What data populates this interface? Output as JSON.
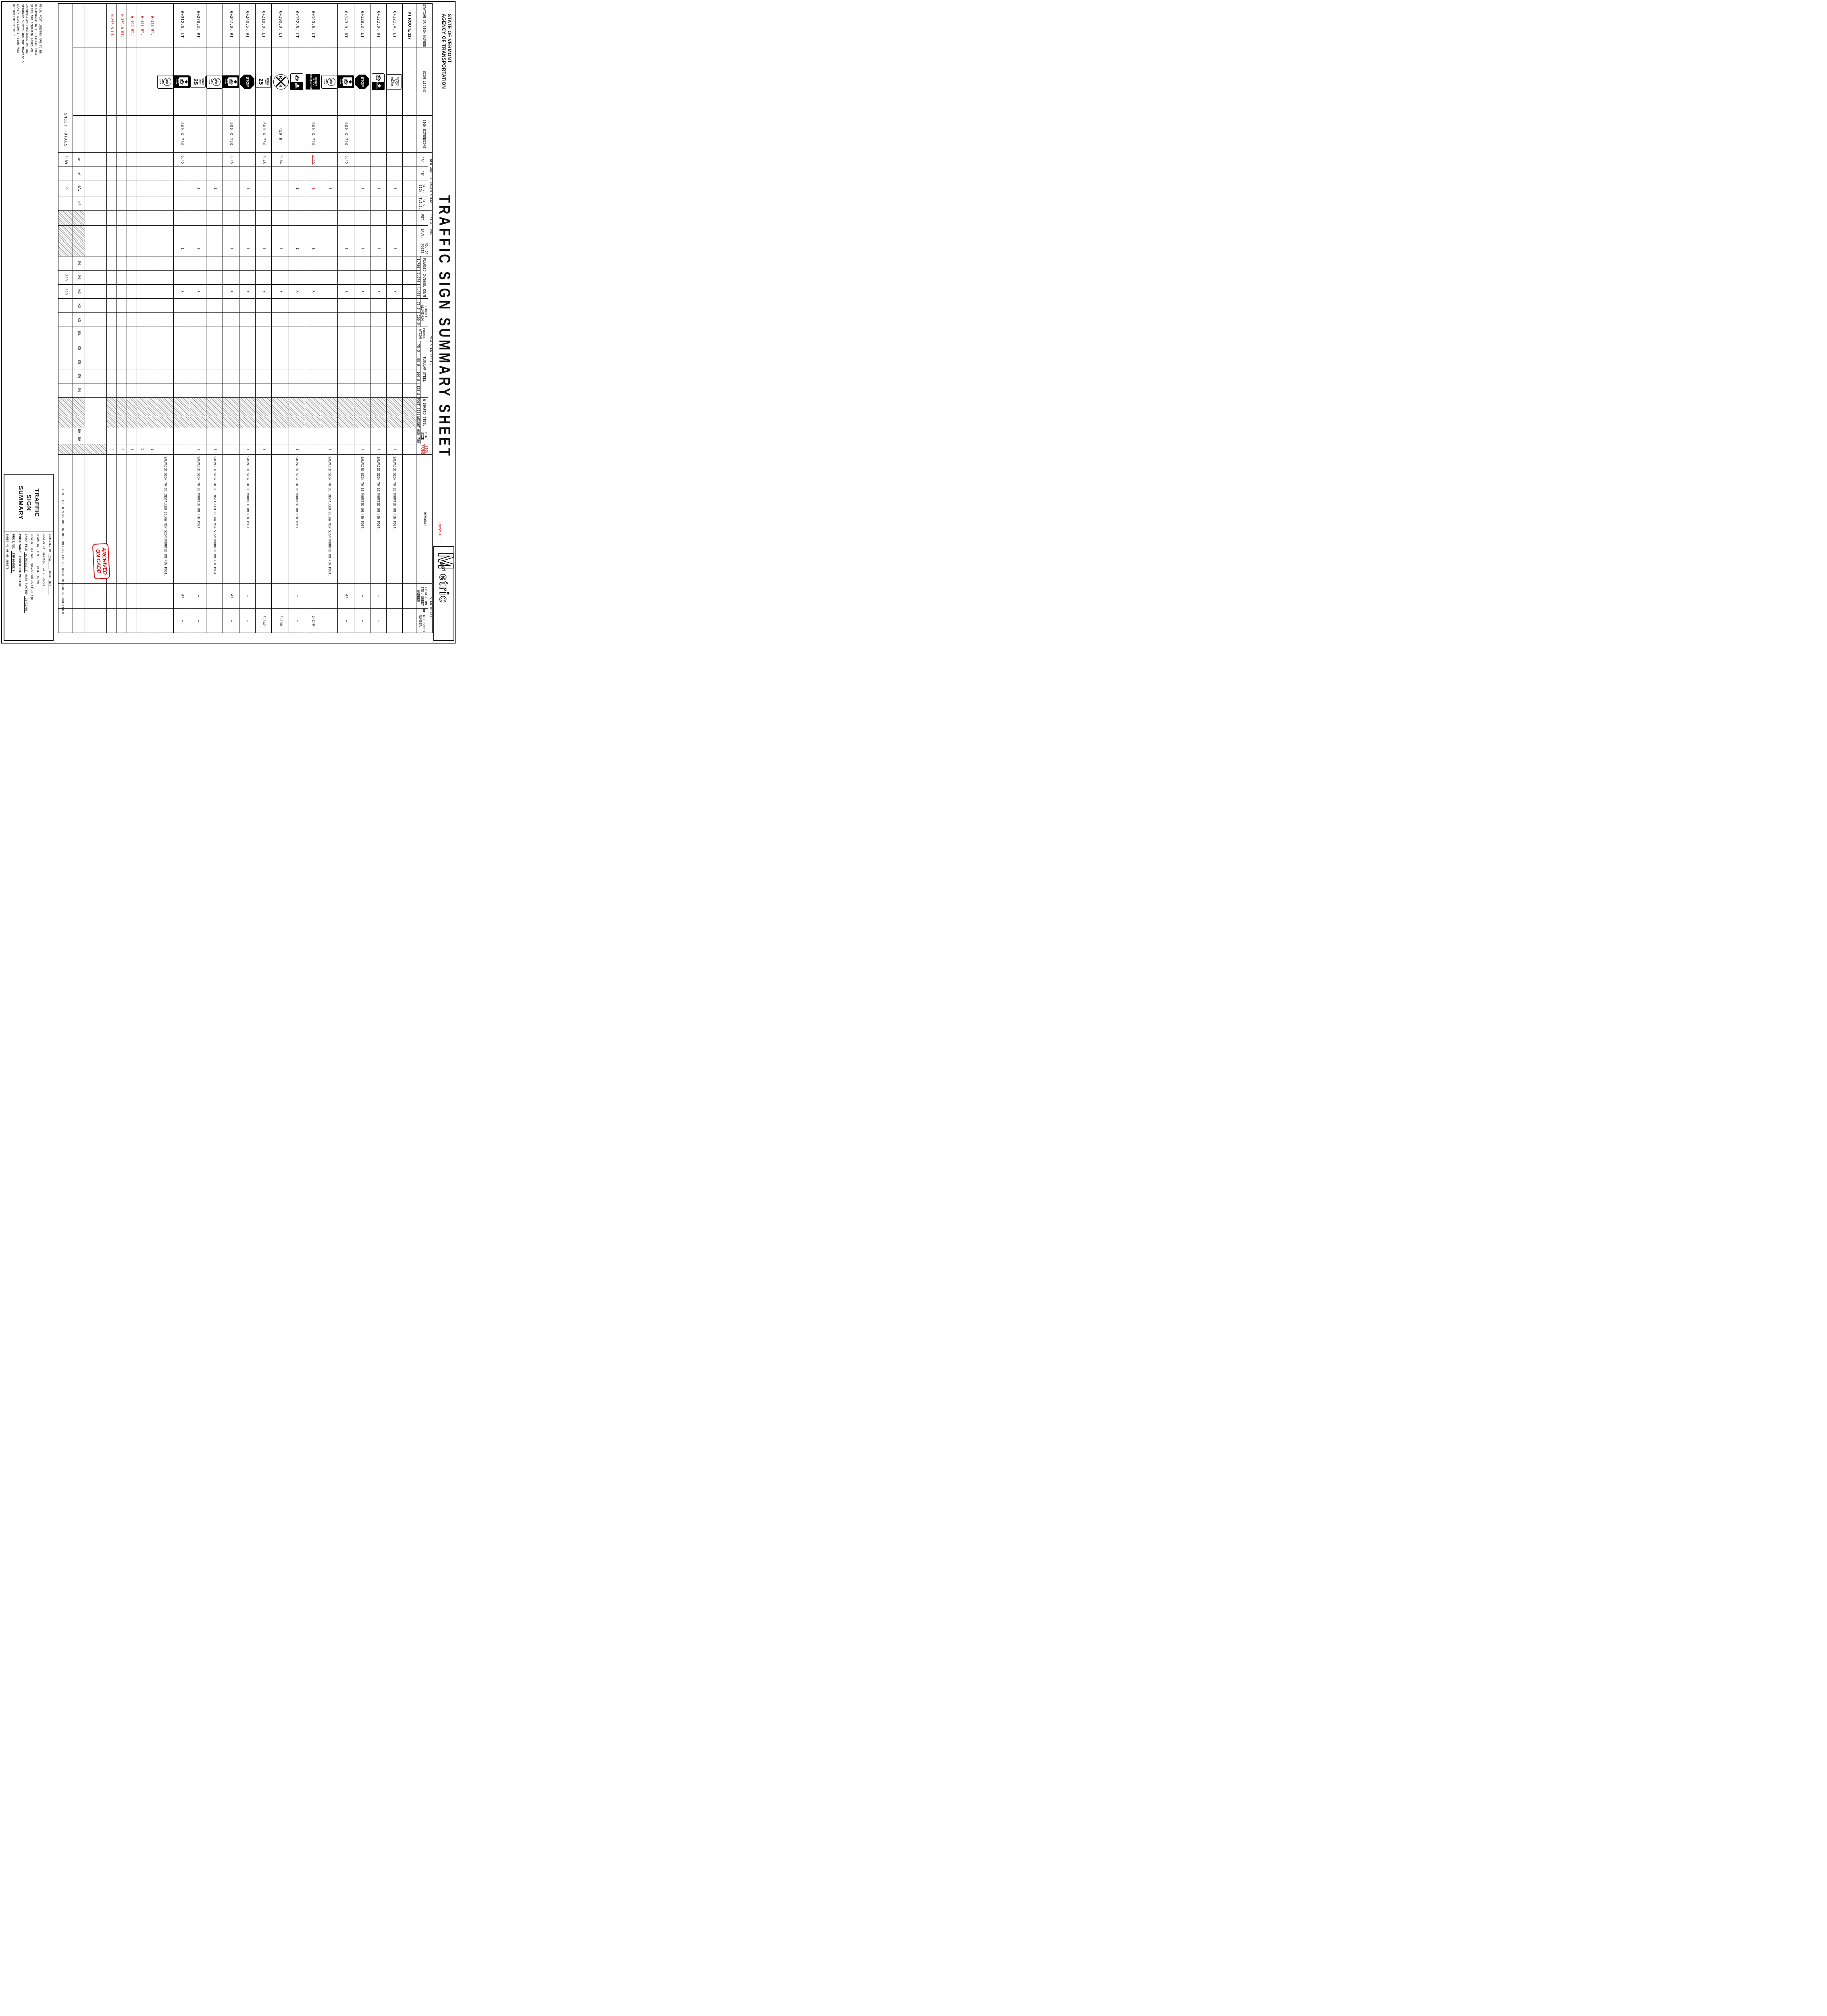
{
  "sheet": {
    "agency_line1": "STATE OF VERMONT",
    "agency_line2": "AGENCY OF TRANSPORTATION",
    "title": "TRAFFIC SIGN SUMMARY SHEET",
    "logo": {
      "m": "M",
      "vaot": "VAOT",
      "rest": "etric"
    }
  },
  "headers": {
    "station": "STATION OR SIGN NUMBER",
    "legend": "SIGN LEGEND",
    "dims": "SIGN DIMENSIONS",
    "new_salvaged": "NEW AND SALVAGED SIGNS",
    "a": "\"A\"",
    "b": "\"B\"",
    "salv_sign": "SALV. SIGN",
    "salv_tis": "SALV. T.I.S.",
    "exist_post": "EXIST. POST",
    "ret": "RET.",
    "salv": "SALV.",
    "posts": "NO. OF POSTS",
    "new_sign_posts": "NEW SIGN POSTS",
    "flanged": "FLANGED CHANNEL KG/M",
    "fc1": "1.786",
    "fc2": "2.976",
    "fc3": "4.465",
    "tub_alum": "TUBULAR ALUMINUM",
    "ta75": "75 Ø",
    "ta100": "100 Ø",
    "foundation": "FOUND- ATION",
    "tub_steel": "TUBULAR STEEL",
    "ts75": "75 Ø",
    "ts90": "90 Ø",
    "ts100": "100 Ø",
    "ts125": "125 Ø",
    "w_shaped": "W SHAPED STEEL",
    "post_size": "POST SIZE",
    "weight": "WEIGHT",
    "ftg": "FTG. SIZE",
    "ftg600": "600",
    "ftg750": "750",
    "frame": "SIGN FRAME",
    "frame_note": "Remove",
    "remarks": "REMARKS",
    "sign_detail": "SIGN DETAIL",
    "detail_std": "DETAIL ON STD. SHEET NUMBER",
    "detail_sheet": "DETAIL SHEET NUMBER"
  },
  "icons": {
    "do-not-stop-on-tracks": {
      "kind": "text-white",
      "lines": [
        "DO NOT",
        "STOP",
        "ON",
        "TRACKS"
      ]
    },
    "do-not-block-intersection": {
      "kind": "text-black",
      "lines": [
        "DO NOT",
        "BLOCK",
        "INTERSECTION"
      ]
    },
    "stop": {
      "kind": "octagon",
      "lines": [
        "STOP"
      ]
    },
    "speed-limit-25": {
      "kind": "speed",
      "lines": [
        "SPEED",
        "LIMIT"
      ],
      "value": "25"
    },
    "rxr": {
      "kind": "rxr",
      "left": "R",
      "right": "R"
    },
    "bike-lane-ahead": {
      "kind": "bike-split",
      "panel": "LANE",
      "word": "AHEAD"
    },
    "bike-lane-ends": {
      "kind": "bike-split",
      "panel": "LANE",
      "word": "ENDS"
    },
    "right-lane-bike-only": {
      "kind": "bike-panel",
      "panel_word": "ONLY",
      "side": [
        "RIGHT",
        "LANE"
      ]
    },
    "bike-lane": {
      "kind": "bike-circle",
      "lines": [
        "BIKE",
        "LANE"
      ]
    }
  },
  "rows": [
    {
      "station": "VT ROUTE 117",
      "bold": true
    },
    {
      "station": "0+121.4, LT.",
      "icon": "do-not-stop-on-tracks",
      "salv_sign": "1",
      "posts": "1",
      "fc3": "X",
      "frame": "1",
      "remarks": "SALVAGED SIGN TO BE MOUNTED ON NEW POST.",
      "detail_std": "—",
      "detail_sheet": "—"
    },
    {
      "station": "0+122.0, RT.",
      "icon": "bike-lane-ahead",
      "salv_sign": "1",
      "posts": "1",
      "fc3": "X",
      "frame": "1",
      "remarks": "SALVAGED SIGN TO BE MOUNTED ON NEW POST.",
      "detail_std": "—",
      "detail_sheet": "—"
    },
    {
      "station": "0+128.3, LT.",
      "icon": "stop",
      "salv_sign": "1",
      "posts": "1",
      "fc3": "X",
      "frame": "1",
      "remarks": "SALVAGED SIGN TO BE MOUNTED ON NEW POST.",
      "detail_std": "—",
      "detail_sheet": "—"
    },
    {
      "station": "0+143.0, RT.",
      "icon": "right-lane-bike-only",
      "dims": "600 X 750",
      "a": "0.45",
      "posts": "1",
      "fc3": "X",
      "detail_std": "47",
      "detail_sheet": "—"
    },
    {
      "station": "",
      "icon": "bike-lane",
      "salv_sign": "1",
      "frame": "1",
      "remarks": "SALVAGED SIGN TO BE INSTALLED BELOW NEW SIGN MOUNTED ON NEW POST.",
      "detail_std": "—",
      "detail_sheet": "—"
    },
    {
      "station": "0+145.6, LT.",
      "icon": "do-not-block-intersection",
      "dims": "600 X 750",
      "a": "0.45",
      "a_struck": true,
      "salv_sign": "1",
      "salv_red": true,
      "posts": "1",
      "fc3": "X",
      "detail_sheet": "E-140"
    },
    {
      "station": "0+152.8, LT.",
      "icon": "bike-lane-ends",
      "salv_sign": "1",
      "posts": "1",
      "fc3": "X",
      "frame": "1",
      "remarks": "SALVAGED SIGN TO BE MOUNTED ON NEW POST.",
      "detail_std": "—",
      "detail_sheet": "—"
    },
    {
      "station": "0+190.0, LT.",
      "icon": "rxr",
      "dims": "450 R",
      "a": "0.64",
      "posts": "1",
      "fc3": "X",
      "detail_sheet": "E-190"
    },
    {
      "station": "0+218.0, LT.",
      "icon": "speed-limit-25",
      "dims": "600 X 750",
      "a": "0.45",
      "posts": "1",
      "fc3": "X",
      "frame": "1",
      "detail_sheet": "E-142"
    },
    {
      "station": "0+240.5, RT.",
      "icon": "stop",
      "salv_sign": "1",
      "posts": "1",
      "fc3": "X",
      "frame": "1",
      "remarks": "SALVAGED SIGN TO BE MOUNTED ON NEW POST.",
      "detail_std": "—",
      "detail_sheet": "—"
    },
    {
      "station": "0+247.0, RT.",
      "icon": "right-lane-bike-only",
      "dims": "600 X 750",
      "a": "0.45",
      "posts": "1",
      "fc3": "X",
      "detail_std": "47",
      "detail_sheet": "—"
    },
    {
      "station": "",
      "icon": "bike-lane",
      "salv_sign": "1",
      "frame": "1",
      "remarks": "SALVAGED SIGN TO BE INSTALLED BELOW NEW SIGN MOUNTED ON NEW POST.",
      "detail_std": "—",
      "detail_sheet": "—"
    },
    {
      "station": "0+278.3, RT.",
      "icon": "speed-limit-25",
      "salv_sign": "1",
      "posts": "1",
      "fc3": "X",
      "frame": "1",
      "remarks": "SALVAGED SIGN TO BE MOUNTED ON NEW POST.",
      "detail_std": "—",
      "detail_sheet": "—"
    },
    {
      "station": "0+312.0, LT.",
      "icon": "right-lane-bike-only",
      "dims": "600 X 750",
      "a": "0.45",
      "posts": "1",
      "fc3": "X",
      "detail_std": "47",
      "detail_sheet": "—"
    },
    {
      "station": "",
      "icon": "bike-lane",
      "remarks": "SALVAGED SIGN TO BE INSTALLED BELOW NEW SIGN MOUNTED ON NEW POST.",
      "detail_std": "—",
      "detail_sheet": "—"
    },
    {
      "station": "0+148 RT.",
      "red": true,
      "frame": "1"
    },
    {
      "station": "0+153 RT.",
      "red": true,
      "frame": "2"
    },
    {
      "station": "0+192 RT.",
      "red": true,
      "frame": "1"
    },
    {
      "station": "0+379.8 RT.",
      "red": true,
      "frame": "2"
    },
    {
      "station": "0+255.5 LT.",
      "red": true,
      "frame": "2"
    },
    {
      "station": "",
      "spacer": true
    }
  ],
  "units_row": {
    "a": "m²",
    "b": "m²",
    "salv_sign": "EA.",
    "salv_tis": "m²",
    "fc1": "KG",
    "fc2": "KG",
    "fc3": "KG",
    "ta75": "KG",
    "ta100": "KG",
    "found": "EA.",
    "ts75": "KG",
    "ts90": "KG",
    "ts100": "KG",
    "ts125": "KG",
    "weight": "KG",
    "ftg600": "EA.",
    "ftg750": "EA."
  },
  "totals_row": {
    "label": "SHEET TOTALS",
    "a": "2.89",
    "salv_sign": "9",
    "fc2": "229",
    "fc3": "229"
  },
  "notes": {
    "field_note": "FINAL POST LENGTHS ARE TO BE DETERMINED IN THE FIELD. POST SIZES ARE COMPUTED BASED ON INFORMATION FURNISHED ON THE STANDARD SHEETS AND THE TRAFFIC & SAFETY DIVISION'S \"SIGN POST DESIGN GUIDELINE.\"",
    "dim_note_label": "NOTE:",
    "dim_note": "ALL DIMENSIONS IN MILLIMETERS EXCEPT WHERE OTHERWISE INDICATED"
  },
  "stamp": {
    "line1": "ARCHIVED",
    "line2": "ON CADD"
  },
  "title_block": {
    "title_lines": [
      "TRAFFIC",
      "SIGN",
      "SUMMARY"
    ],
    "fields": [
      {
        "label": "SURVEYED BY",
        "value": "N/A",
        "label2": "DATE",
        "value2": "N/A"
      },
      {
        "label": "DESIGN BY",
        "value": "JLL/CAE",
        "label2": "DATE",
        "value2": "09/96"
      },
      {
        "label": "DRAWN BY",
        "value": "W-M",
        "label2": "DATE",
        "value2": "09/96"
      },
      {
        "label": "DESIGN FILE NO.",
        "value": "/pave/95dl02/pdl02.dgn"
      },
      {
        "label": "IPARM FILE",
        "value": "pdl02tsi.i",
        "label2": "DATE PLOTTED",
        "value2": "10/11/96"
      },
      {
        "label": "PROJ. NAME",
        "value": "ESSEX JCT. VILLAGE",
        "bold": true
      },
      {
        "label": "PROJ. NO.",
        "value": "STP 9645(1)S",
        "bold": true
      },
      {
        "label": "SHEET 42 OF 48 SHEETS"
      }
    ]
  },
  "colors": {
    "markup_red": "#d40000",
    "line_black": "#000000"
  }
}
